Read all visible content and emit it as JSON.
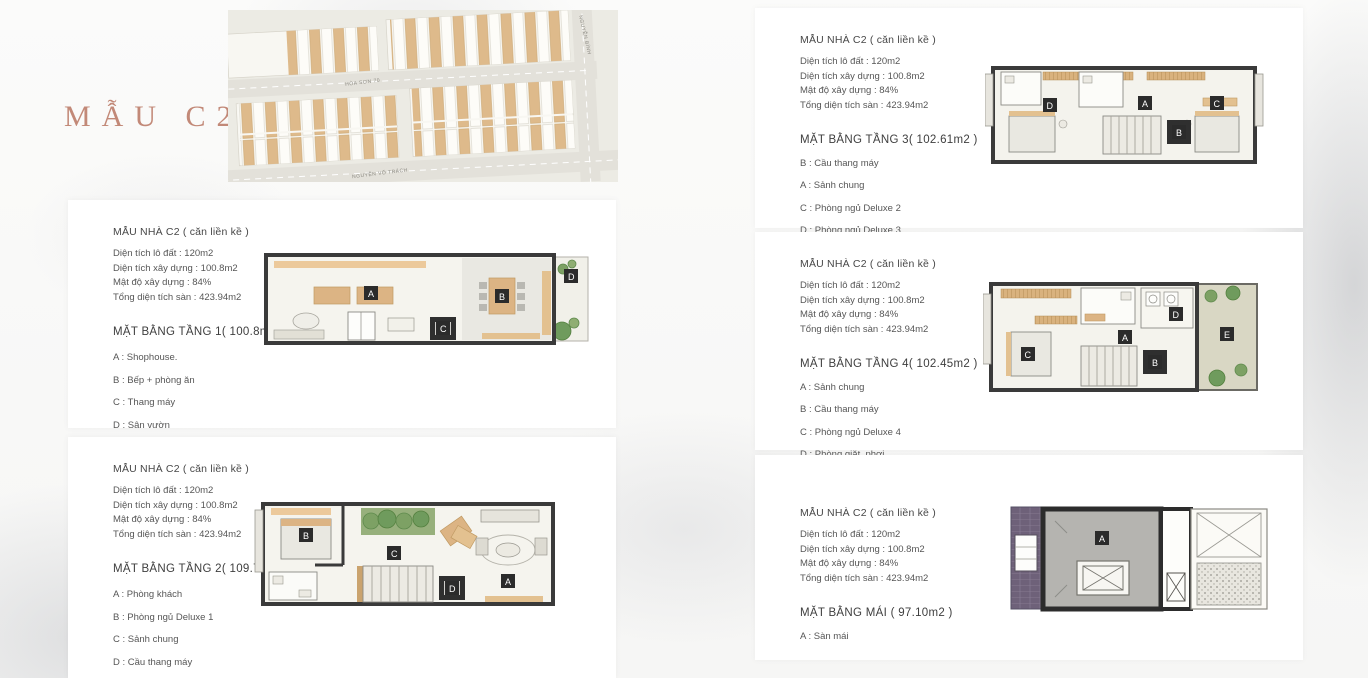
{
  "page_title": "MẪU C2",
  "site_map": {
    "street_labels": {
      "middle": "HÒA SƠN 70",
      "bottom": "NGUYỄN VÕ TRÁCH",
      "right": "NGUYỄN BÍNH"
    }
  },
  "colors": {
    "accent_title": "#c28978",
    "lot_tan": "#deba8b",
    "wall_dark": "#3a3a3a",
    "plant_green": "#7da164",
    "roof_gray": "#b5b4b0",
    "tile_purple": "#6e6179"
  },
  "panels": [
    {
      "header": "MẪU NHÀ C2 ( căn liền kề )",
      "stats": [
        "Diện tích lô đất : 120m2",
        "Diện tích xây dựng : 100.8m2",
        "Mật độ xây dựng : 84%",
        "Tổng diện tích sàn : 423.94m2"
      ],
      "floor_title": "MẶT BẰNG TẦNG 1( 100.8m2 )",
      "legend": [
        "A : Shophouse.",
        "B : Bếp  + phòng ăn",
        "C : Thang máy",
        "D : Sân vườn"
      ],
      "plan_labels": [
        "A",
        "B",
        "C",
        "D"
      ]
    },
    {
      "header": "MẪU NHÀ C2 ( căn liền kề )",
      "stats": [
        "Diện tích lô đất : 120m2",
        "Diện tích xây dựng : 100.8m2",
        "Mật độ xây dựng : 84%",
        "Tổng diện tích sàn : 423.94m2"
      ],
      "floor_title": "MẶT BẰNG TẦNG 2( 109.78m2 )",
      "legend": [
        "A : Phòng khách",
        "B : Phòng ngủ Deluxe 1",
        "C : Sảnh chung",
        "D : Cầu thang máy"
      ],
      "plan_labels": [
        "B",
        "C",
        "D",
        "A"
      ]
    },
    {
      "header": "MẪU NHÀ C2 ( căn liền kề )",
      "stats": [
        "Diện tích lô đất : 120m2",
        "Diện tích xây dựng : 100.8m2",
        "Mật độ xây dựng : 84%",
        "Tổng diện tích sàn : 423.94m2"
      ],
      "floor_title": "MẶT BẰNG TẦNG 3( 102.61m2 )",
      "legend": [
        "B : Cầu thang máy",
        "A : Sảnh chung",
        "C : Phòng ngủ Deluxe 2",
        "D : Phòng ngủ Deluxe 3"
      ],
      "plan_labels": [
        "D",
        "A",
        "B",
        "C"
      ]
    },
    {
      "header": "MẪU NHÀ C2 ( căn liền kề )",
      "stats": [
        "Diện tích lô đất : 120m2",
        "Diện tích xây dựng : 100.8m2",
        "Mật độ xây dựng : 84%",
        "Tổng diện tích sàn : 423.94m2"
      ],
      "floor_title": "MẶT BẰNG TẦNG 4( 102.45m2 )",
      "legend": [
        "A : Sảnh chung",
        "B : Cầu thang máy",
        "C : Phòng ngủ Deluxe 4",
        "D : Phòng giặt, phơi",
        "E : Sân vườn ngoài trời"
      ],
      "plan_labels": [
        "C",
        "A",
        "D",
        "B",
        "E"
      ]
    },
    {
      "header": "MẪU NHÀ C2 ( căn liền kề )",
      "stats": [
        "Diện tích lô đất : 120m2",
        "Diện tích xây dựng : 100.8m2",
        "Mật độ xây dựng : 84%",
        "Tổng diện tích sàn : 423.94m2"
      ],
      "floor_title": "MẶT BẰNG MÁI ( 97.10m2 )",
      "legend": [
        "A : Sàn mái"
      ],
      "plan_labels": [
        "A"
      ]
    }
  ]
}
